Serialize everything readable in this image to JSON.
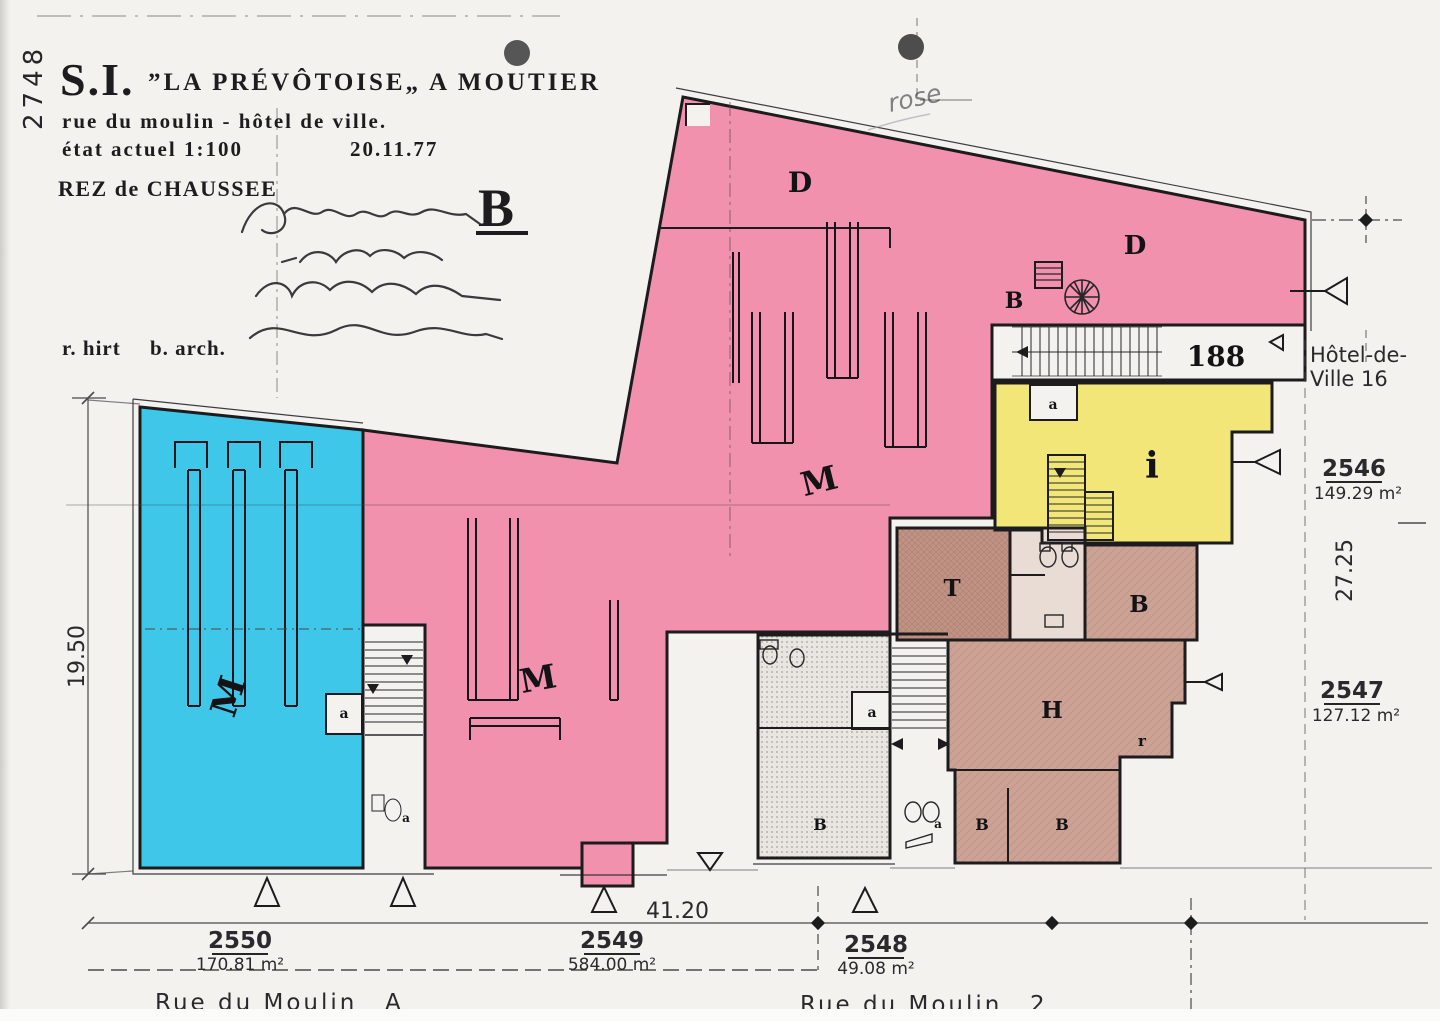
{
  "header": {
    "registry_number": "2748",
    "company_prefix": "S.I.",
    "company_name": "”LA PRÉVÔTOISE„ A MOUTIER",
    "address_line": "rue du moulin - hôtel de ville.",
    "state_label": "état actuel 1:100",
    "date": "20.11.77",
    "floor_label": "REZ de CHAUSSEE",
    "sheet_letter": "B",
    "architect_name": "r. hirt",
    "architect_title": "b. arch.",
    "handwritten_note": "rose"
  },
  "plan": {
    "room_labels": [
      {
        "t": "D",
        "x": 800,
        "y": 192,
        "s": 28,
        "r": 0
      },
      {
        "t": "D",
        "x": 1135,
        "y": 254,
        "s": 26,
        "r": 0
      },
      {
        "t": "B",
        "x": 1014,
        "y": 308,
        "s": 22,
        "r": 0
      },
      {
        "t": "M",
        "x": 240,
        "y": 700,
        "s": 36,
        "r": -72
      },
      {
        "t": "M",
        "x": 822,
        "y": 492,
        "s": 33,
        "r": -14
      },
      {
        "t": "M",
        "x": 540,
        "y": 690,
        "s": 33,
        "r": -10
      },
      {
        "t": "i",
        "x": 1152,
        "y": 478,
        "s": 36,
        "r": 0
      },
      {
        "t": "T",
        "x": 952,
        "y": 596,
        "s": 23,
        "r": 0
      },
      {
        "t": "B",
        "x": 1139,
        "y": 612,
        "s": 23,
        "r": 0
      },
      {
        "t": "H",
        "x": 1052,
        "y": 718,
        "s": 23,
        "r": 0
      },
      {
        "t": "r",
        "x": 1142,
        "y": 746,
        "s": 15,
        "r": 0
      },
      {
        "t": "B",
        "x": 820,
        "y": 830,
        "s": 16,
        "r": 0
      },
      {
        "t": "B",
        "x": 982,
        "y": 830,
        "s": 16,
        "r": 0
      },
      {
        "t": "B",
        "x": 1062,
        "y": 830,
        "s": 16,
        "r": 0
      },
      {
        "t": "188",
        "x": 1216,
        "y": 366,
        "s": 28,
        "r": 0
      },
      {
        "t": "a",
        "x": 344,
        "y": 718,
        "s": 14,
        "r": 0
      },
      {
        "t": "a",
        "x": 1053,
        "y": 409,
        "s": 14,
        "r": 0
      },
      {
        "t": "a",
        "x": 872,
        "y": 717,
        "s": 14,
        "r": 0
      },
      {
        "t": "a",
        "x": 406,
        "y": 822,
        "s": 12,
        "r": 0
      },
      {
        "t": "a",
        "x": 938,
        "y": 828,
        "s": 12,
        "r": 0
      }
    ]
  },
  "dimensions": {
    "left_height": "19.50",
    "right_height": "27.25",
    "bottom_width": "41.20"
  },
  "parcels": [
    {
      "number": "2550",
      "area": "170.81 m²"
    },
    {
      "number": "2549",
      "area": "584.00 m²"
    },
    {
      "number": "2548",
      "area": "49.08 m²"
    },
    {
      "number": "2546",
      "area": "149.29 m²"
    },
    {
      "number": "2547",
      "area": "127.12 m²"
    }
  ],
  "neighbor": {
    "line1": "Hôtel-de-",
    "line2": "Ville 16"
  },
  "streets": [
    {
      "name": "Rue du Moulin",
      "number": "A"
    },
    {
      "name": "Rue du Moulin",
      "number": "2"
    }
  ],
  "palette": {
    "pink": "#f191ad",
    "cyan": "#3ec7e8",
    "yellow": "#f2e678",
    "tan": "#cba294",
    "tan_dark": "#c29384",
    "gray_room": "#e9e6e1",
    "paper": "#f4f2ee",
    "ink": "#1c1c1f",
    "dim_line": "#4a4a4a"
  }
}
